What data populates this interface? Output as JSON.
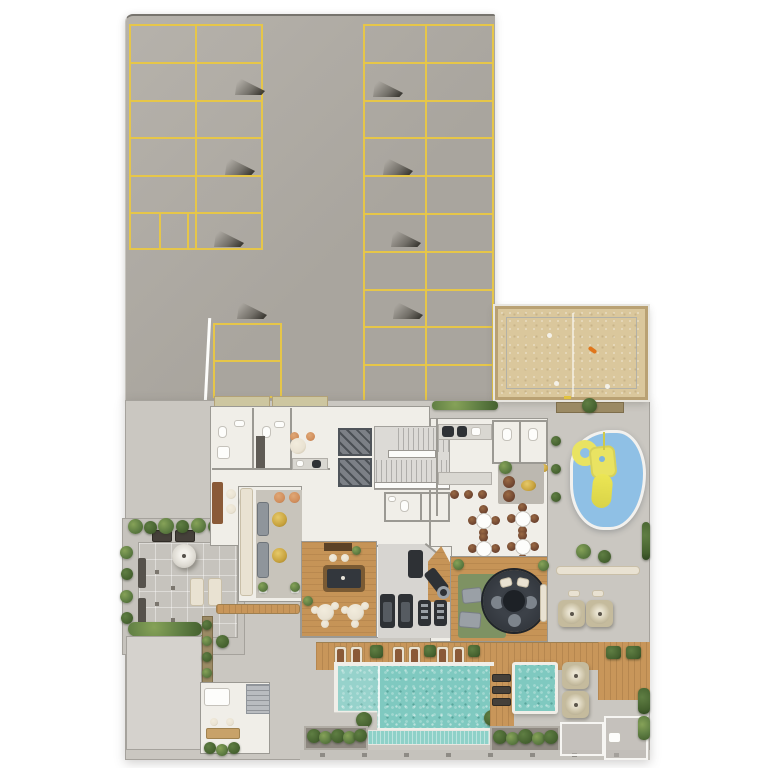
{
  "meta": {
    "canvas": {
      "width": 768,
      "height": 768
    }
  },
  "colors": {
    "bg": "#ffffff",
    "asphalt": "#a9a59e",
    "asphalt_light": "#b6b2ab",
    "concrete": "#cac7c1",
    "concrete_light": "#d5d2cd",
    "paver": "#c6c3bd",
    "line_yellow": "#e6c649",
    "wall_outline": "#9b9993",
    "wall_white": "#fbfbf9",
    "floor": "#f0eee8",
    "floor_gym": "#d7d5d1",
    "wood": "#c69457",
    "deck": "#c8965a",
    "sand": "#dac79c",
    "sand_frame": "#b9a173",
    "water": "#7fc9c0",
    "water_light": "#abdfd7",
    "trough": "#8ed1c8",
    "play_mat": "#8fc0e5",
    "play_yellow": "#e9e362",
    "plant": "#5f7e43",
    "plant_dark": "#44602e",
    "plant_light": "#86a258",
    "dark_equip": "#2e3135",
    "shaft": "#7c8086",
    "gray_furn": "#8f959b",
    "cream": "#e9e2d2",
    "gold": "#c8a33e",
    "brown": "#8a5a38",
    "chair_brown": "#6f4530",
    "peach": "#d08d5b",
    "green_rug": "#7e9263",
    "rug_dark": "#2b2f35",
    "counter": "#d9d7d1",
    "parasol": "#c5bb9d",
    "orange": "#e0761b",
    "machine_gray": "#b9bcc0"
  },
  "areas": {
    "parking_lot": {
      "surface": "asphalt",
      "left_bank_spaces": 12,
      "right_bank_spaces": 20,
      "lower_bank_spaces": 2,
      "structural_columns": 8,
      "marking_color": "#e6c649"
    },
    "sand_court": {
      "surface": "sand",
      "center_line": true,
      "scattered_items": 5
    },
    "kids_playground": {
      "surface": "blue-rubber-mat",
      "equipment": [
        "climb-ring",
        "play-tower",
        "slide"
      ]
    },
    "amenities_floor": {
      "rooms": [
        "restrooms",
        "meeting-room",
        "kitchenette",
        "office",
        "sofa-lounge",
        "elevator-bank",
        "staircase",
        "wc",
        "party-room",
        "party-kitchen",
        "bar-counter",
        "dining-area",
        "lounge-nook",
        "games-room",
        "gym",
        "tv-lounge"
      ],
      "elevators": 2,
      "dining_tables": 4,
      "billiards_tables": 1,
      "treadmills": 2,
      "sofas": 2,
      "gold_side_tables": 2
    },
    "garden_terrace": {
      "features": [
        "white-parasol",
        "sun-loungers",
        "benches",
        "paver-grid",
        "perimeter-planting"
      ]
    },
    "pool_deck": {
      "sun_loungers": 6,
      "dark_loungers": 3,
      "planter_boxes": 5
    },
    "main_pool": {
      "water": "turquoise",
      "features": [
        "shallow-shelf",
        "lane-divider",
        "overflow-trough",
        "corner-planters"
      ]
    },
    "spa_pool": {
      "water": "turquoise"
    },
    "terrace_parasols": 4,
    "service_rooms": 3
  }
}
